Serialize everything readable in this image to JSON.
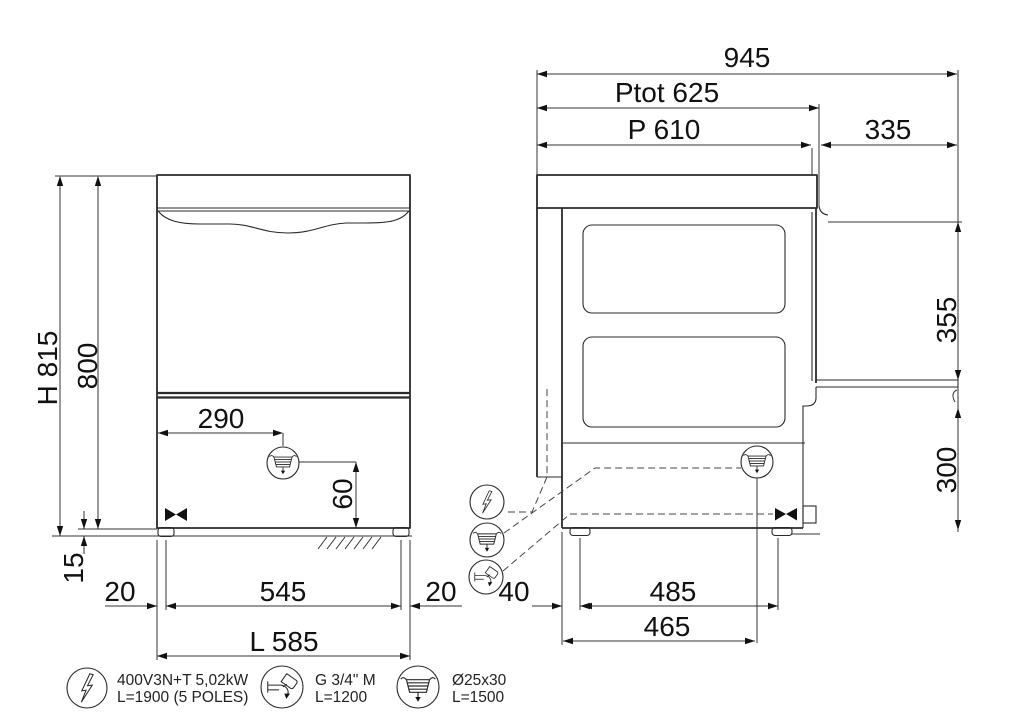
{
  "front": {
    "height_total": "H 815",
    "height_body": "800",
    "height_feet": "15",
    "drain_offset": "290",
    "drain_height": "60",
    "foot_left": "20",
    "feet_span": "545",
    "foot_right": "20",
    "width_total": "L 585"
  },
  "side": {
    "depth_total": "945",
    "depth_ptot": "Ptot 625",
    "depth_p": "P 610",
    "door_extension": "335",
    "clearance_top": "355",
    "door_height": "300",
    "back_offset": "40",
    "feet_span": "485",
    "drain_offset": "465"
  },
  "legend": {
    "electric": {
      "line1": "400V3N+T 5,02kW",
      "line2": "L=1900 (5 POLES)"
    },
    "water": {
      "line1": "G 3/4\" M",
      "line2": "L=1200"
    },
    "drain": {
      "line1": "Ø25x30",
      "line2": "L=1500"
    }
  },
  "colors": {
    "line": "#2a2a2a",
    "background": "#ffffff"
  }
}
